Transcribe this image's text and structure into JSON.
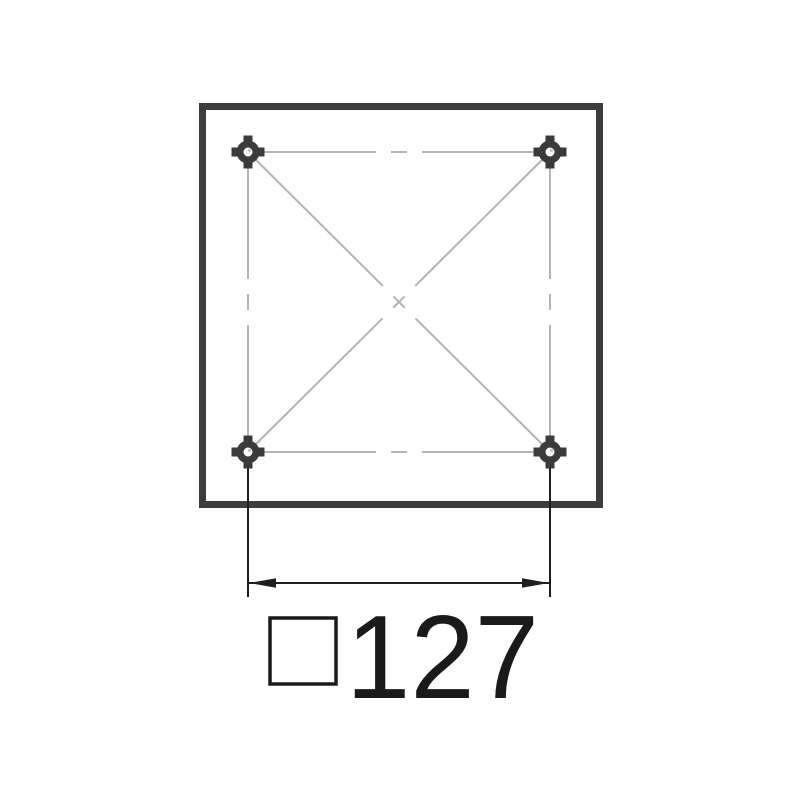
{
  "drawing": {
    "kind": "technical-drawing",
    "description": "Top view of a square mounting plate with four corner holes, crossed diagonal centerlines and a bolt-spacing dimension",
    "dimension": {
      "value": "127",
      "symbol_glyph": "□",
      "symbol_meaning": "square",
      "full_label": "□127"
    },
    "holes": [
      {
        "id": "top-left"
      },
      {
        "id": "top-right"
      },
      {
        "id": "bottom-left"
      },
      {
        "id": "bottom-right"
      }
    ],
    "colors": {
      "background": "#ffffff",
      "plate_outline": "#3d3d3d",
      "centerline": "#b4b4b4",
      "hole": "#3b3b3b",
      "hole_highlight": "#c8c8c8",
      "dimension_line": "#1f1f1f",
      "text": "#1a1a1a"
    }
  }
}
